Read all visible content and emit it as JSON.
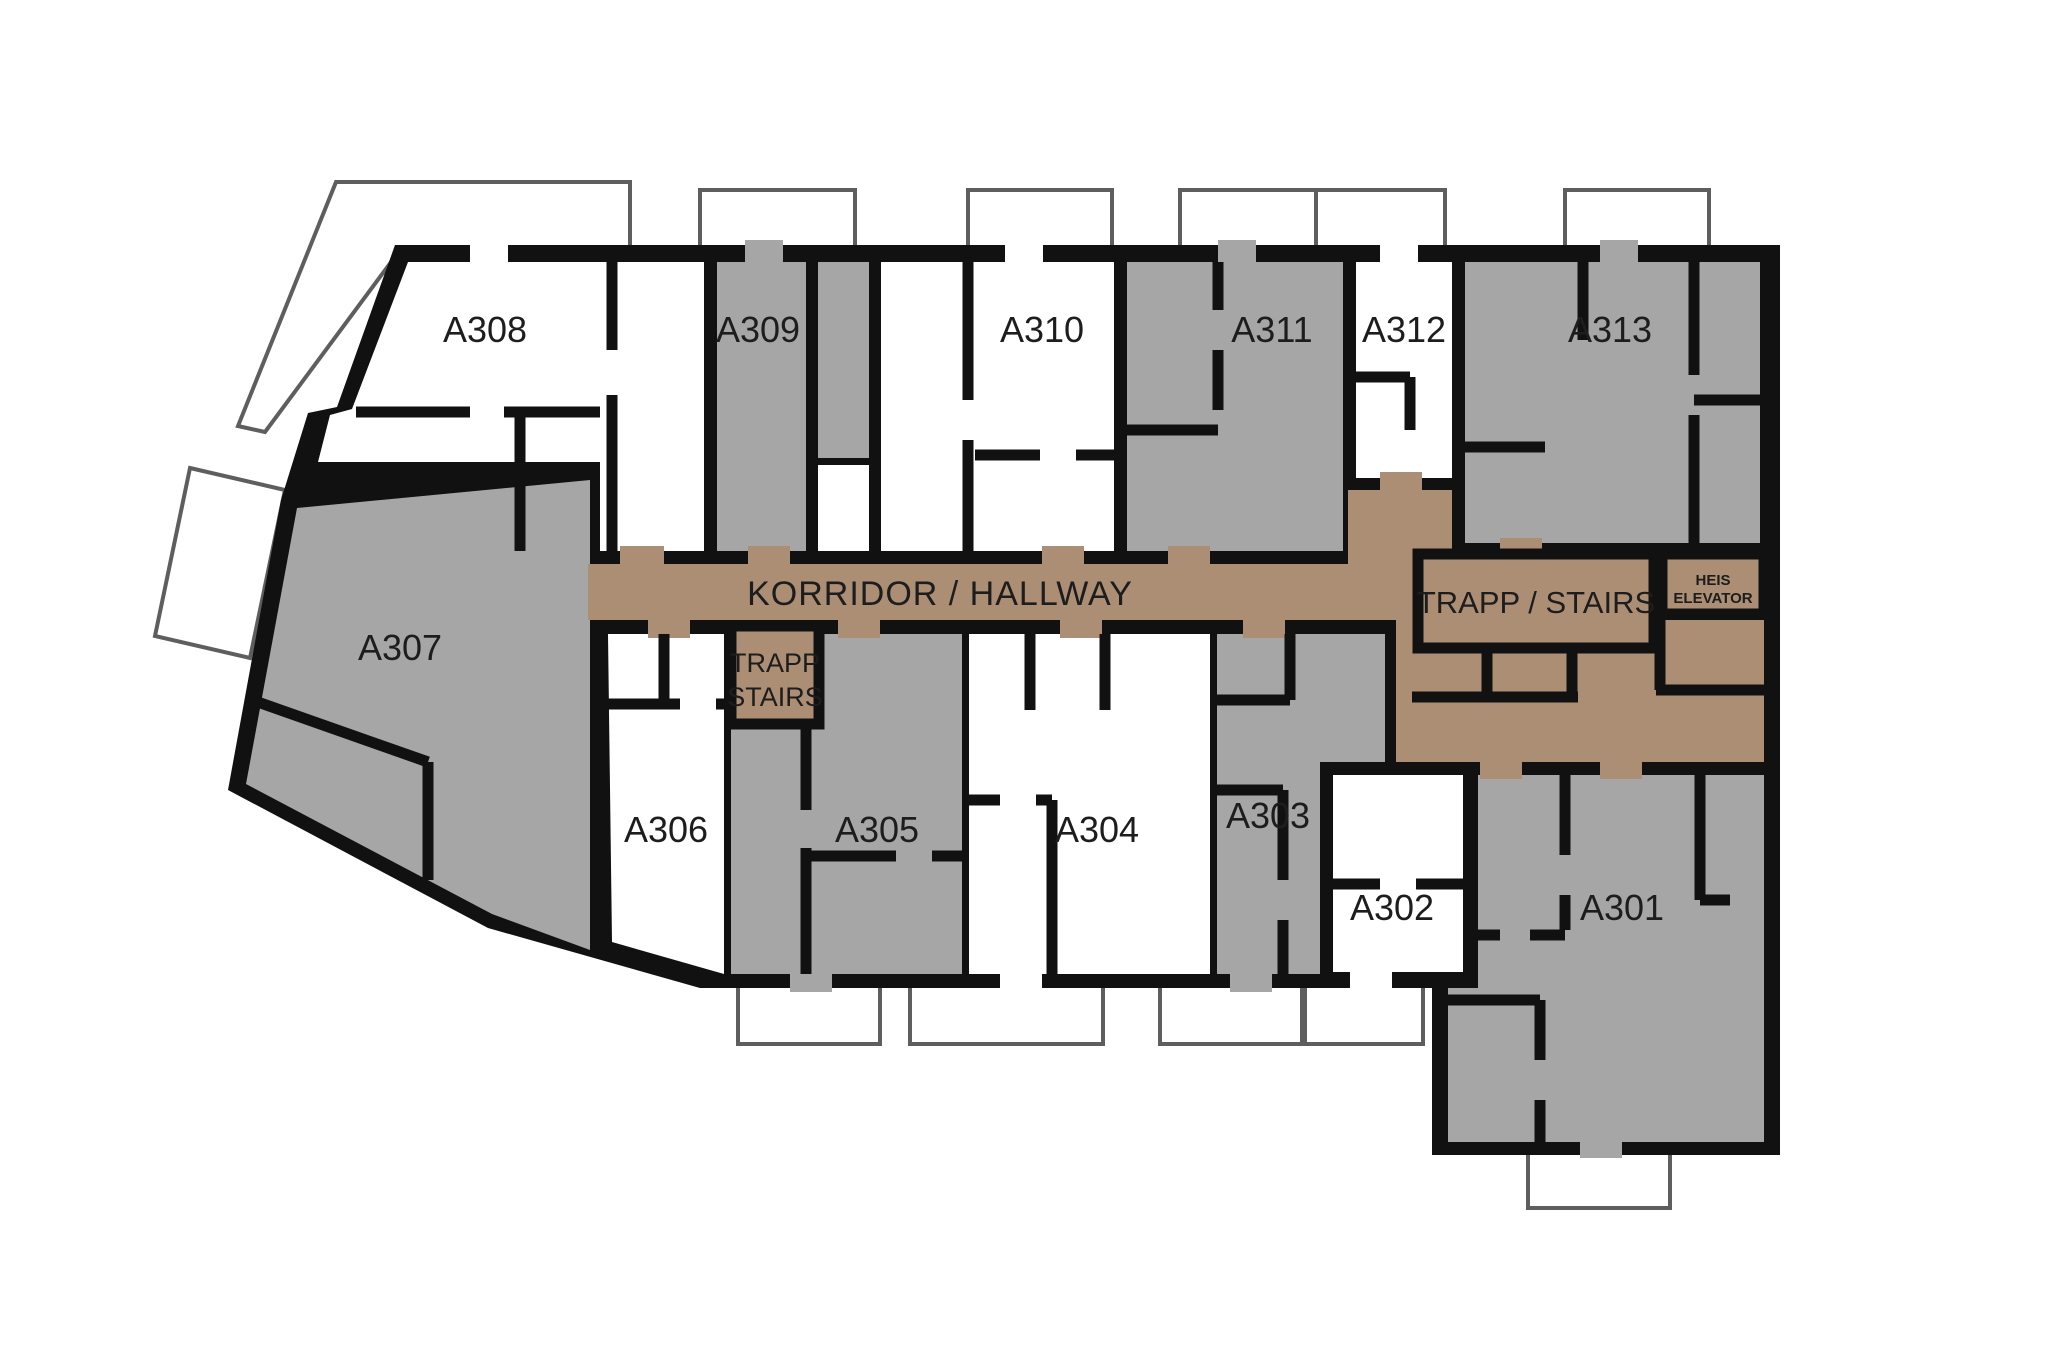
{
  "page": {
    "background": "#FFFFFF"
  },
  "colors": {
    "wall": "#111111",
    "room_gray": "#A6A6A6",
    "room_white": "#FFFFFF",
    "corridor": "#AB8E74",
    "balcony_stroke": "#5E5E5E",
    "label": "#1D1D1D"
  },
  "rooms": [
    {
      "id": "a308",
      "label": "A308",
      "shade": "white"
    },
    {
      "id": "a309",
      "label": "A309",
      "shade": "gray"
    },
    {
      "id": "a310",
      "label": "A310",
      "shade": "white"
    },
    {
      "id": "a311",
      "label": "A311",
      "shade": "gray"
    },
    {
      "id": "a312",
      "label": "A312",
      "shade": "white"
    },
    {
      "id": "a313",
      "label": "A313",
      "shade": "gray"
    },
    {
      "id": "a307",
      "label": "A307",
      "shade": "gray"
    },
    {
      "id": "a306",
      "label": "A306",
      "shade": "white"
    },
    {
      "id": "a305",
      "label": "A305",
      "shade": "gray"
    },
    {
      "id": "a304",
      "label": "A304",
      "shade": "white"
    },
    {
      "id": "a303",
      "label": "A303",
      "shade": "gray"
    },
    {
      "id": "a302",
      "label": "A302",
      "shade": "white"
    },
    {
      "id": "a301",
      "label": "A301",
      "shade": "gray"
    }
  ],
  "corridor_label": "KORRIDOR  / HALLWAY",
  "stairs_main_label": "TRAPP / STAIRS",
  "stairs_small": {
    "line1": "TRAPP",
    "line2": "STAIRS"
  },
  "elevator": {
    "line1": "HEIS",
    "line2": "ELEVATOR"
  }
}
